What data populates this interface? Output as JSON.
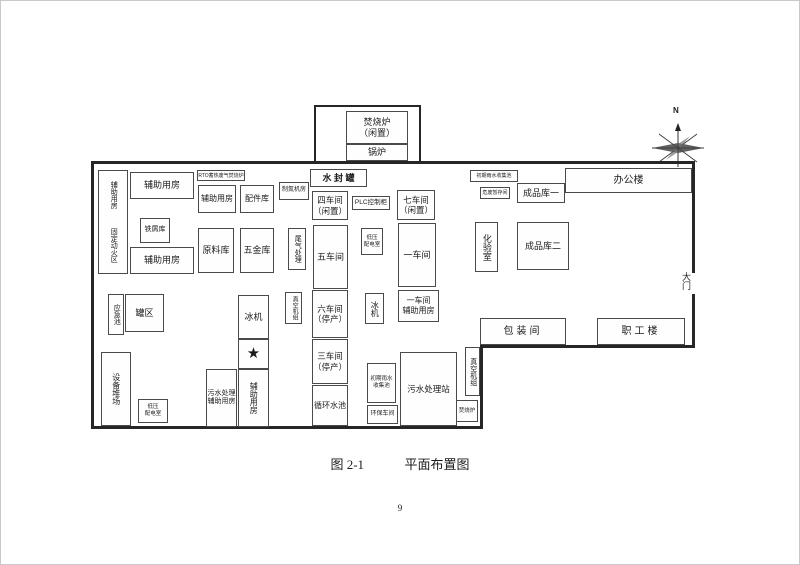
{
  "diagram": {
    "north_label": "N",
    "outbuilding": {
      "incinerator": "焚烧炉\n（闲置）",
      "boiler": "锅炉"
    },
    "rooms": {
      "water_seal_tank": "水 封 罐",
      "aux_room_left": "辅助用房",
      "fixed_fire_zone": "固定动火区",
      "aux_room_top": "辅助用房",
      "scrap_store": "铁屑库",
      "aux_room_bottom": "辅助用房",
      "rto_unit": "RTO蓄热废气焚烧炉",
      "aux_room_mid": "辅助用房",
      "parts_store": "配件库",
      "raw_material_store": "原料库",
      "hardware_store": "五金库",
      "nitrogen_room": "制氮机房",
      "tail_gas_treatment": "尾气处理",
      "workshop4": "四车间\n（闲置）",
      "plc_cabinet": "PLC控制柜",
      "workshop7": "七车间\n（闲置）",
      "workshop5": "五车间",
      "lv_power_room": "低压\n配电室",
      "workshop1": "一车间",
      "rainwater_pool_top": "初期雨水收集池",
      "hazwaste_store": "危废暂存间",
      "finished_store1": "成品库一",
      "office_building": "办公楼",
      "lab": "化验室",
      "finished_store2": "成品库二",
      "ice_machine_left": "冰机",
      "star": "★",
      "aux_room_star": "辅助用房",
      "sewage_aux_room": "污水处理\n辅助用房",
      "workshop6": "六车间\n（停产）",
      "workshop3": "三车间\n（停产）",
      "circulating_pool": "循环水池",
      "vacuum_unit_left": "真空机组",
      "ice_machine_mid": "冰机",
      "workshop1_aux": "一车间\n辅助用房",
      "rainwater_pool_mid": "初期雨水\n收集池",
      "sewage_station": "污水处理站",
      "env_room": "环保车间",
      "incinerator_small": "焚烧炉",
      "vacuum_unit_right": "真空机组",
      "emergency_pool": "应急池",
      "tank_area": "罐区",
      "equipment_yard": "设备堆场",
      "lv_power_room2": "低压\n配电室",
      "packing_room": "包装间",
      "staff_building": "职工楼",
      "gate": "大门"
    }
  },
  "caption": {
    "number": "图 2-1",
    "title": "平面布置图"
  },
  "page": {
    "number": "9"
  }
}
